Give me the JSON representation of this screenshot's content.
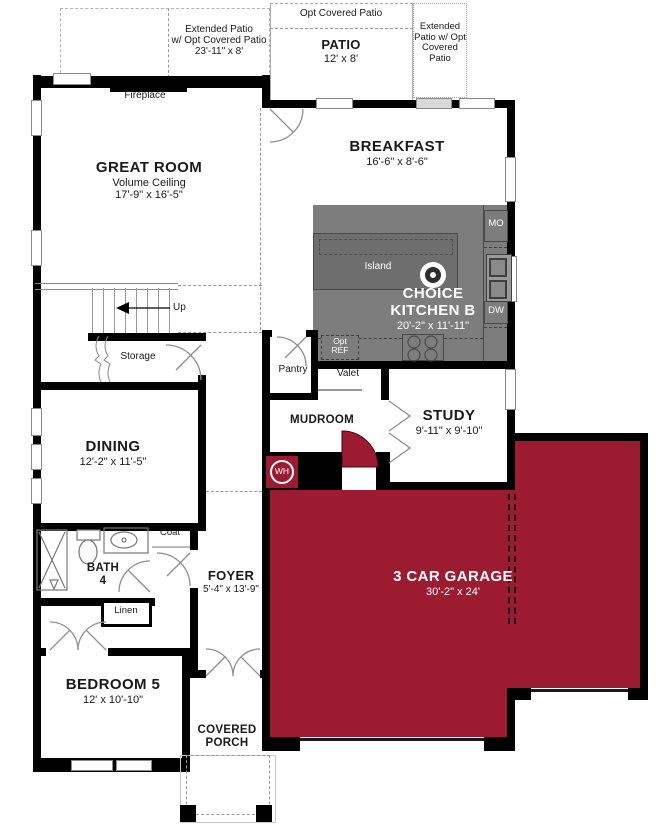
{
  "colors": {
    "garage_red": "#9d1b31",
    "kitchen_gray": "#7d7d7d",
    "island_gray": "#6e6e6e",
    "wall_black": "#000000"
  },
  "patios": {
    "left": {
      "line1": "Extended Patio",
      "line2": "w/ Opt Covered Patio",
      "dims": "23'-11\" x 8'"
    },
    "center": {
      "opt_label": "Opt Covered Patio",
      "name": "PATIO",
      "dims": "12' x 8'"
    },
    "right": {
      "line1": "Extended",
      "line2": "Patio w/ Opt",
      "line3": "Covered",
      "line4": "Patio"
    }
  },
  "rooms": {
    "great_room": {
      "name": "GREAT ROOM",
      "sub": "Volume Ceiling",
      "dims": "17'-9\" x 16'-5\""
    },
    "breakfast": {
      "name": "BREAKFAST",
      "dims": "16'-6\" x 8'-6\""
    },
    "kitchen": {
      "name_line1": "CHOICE",
      "name_line2": "KITCHEN B",
      "dims": "20'-2\" x 11'-11\"",
      "island": "Island",
      "mo": "MO",
      "dw": "DW",
      "ref_line1": "Opt",
      "ref_line2": "REF"
    },
    "dining": {
      "name": "DINING",
      "dims": "12'-2\" x 11'-5\""
    },
    "study": {
      "name": "STUDY",
      "dims": "9'-11\" x 9'-10\""
    },
    "mudroom": {
      "name": "MUDROOM"
    },
    "pantry": {
      "name": "Pantry"
    },
    "valet": {
      "name": "Valet"
    },
    "storage": {
      "name": "Storage"
    },
    "stairs": {
      "up": "Up"
    },
    "fireplace": {
      "name": "Fireplace"
    },
    "bath4": {
      "line1": "BATH",
      "line2": "4"
    },
    "coat": {
      "name": "Coat"
    },
    "linen": {
      "name": "Linen"
    },
    "foyer": {
      "name": "FOYER",
      "dims": "5'-4\" x 13'-9\""
    },
    "bedroom5": {
      "name": "BEDROOM 5",
      "dims": "12' x 10'-10\""
    },
    "garage": {
      "name": "3 CAR GARAGE",
      "dims": "30'-2\" x 24'",
      "wh": "WH"
    },
    "porch": {
      "line1": "COVERED",
      "line2": "PORCH"
    }
  }
}
